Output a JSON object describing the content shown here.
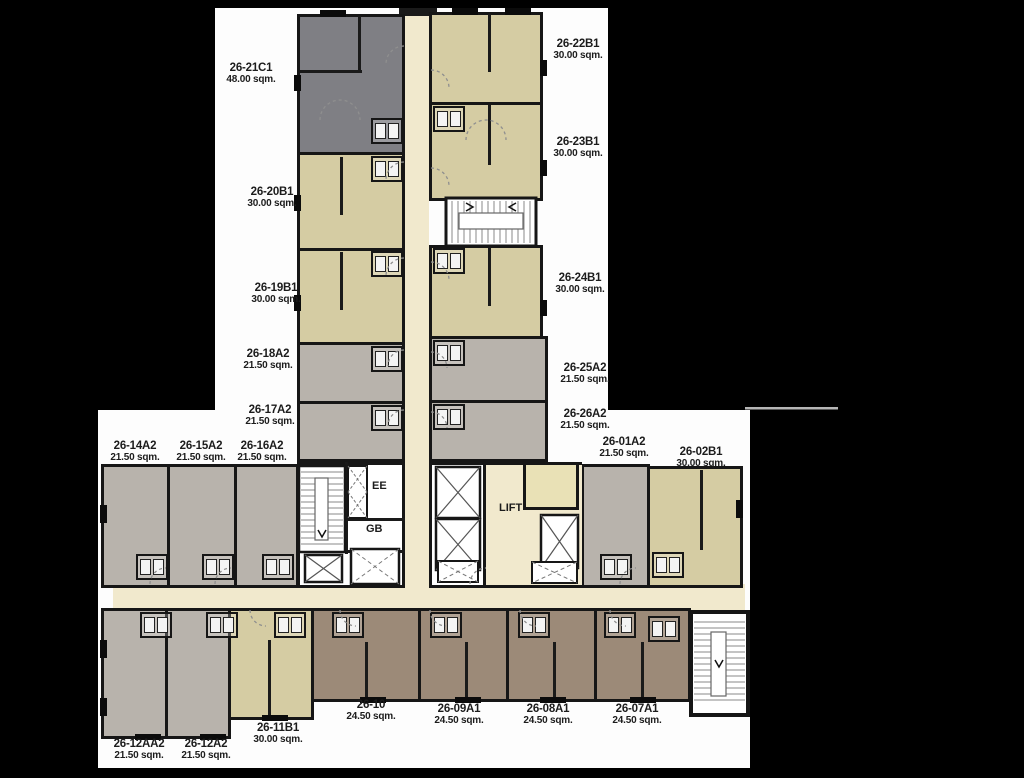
{
  "plan": {
    "type": "residential-floor-plan",
    "floor_prefix": "26",
    "colors": {
      "background": "#000000",
      "plan_paper": "#fdfdfd",
      "unit_c1_gray": "#7f7f84",
      "unit_b1_tan": "#d5cca3",
      "unit_a2_gray": "#b8b3ac",
      "unit_a1_brown": "#9c8a78",
      "corridor_cream": "#f1e9cd",
      "small_room_khaki": "#e9e1b6",
      "walls": "#161616"
    }
  },
  "core": {
    "ee": "EE",
    "gb": "GB",
    "lift": "LIFT"
  },
  "units": [
    {
      "id": "26-21C1",
      "area": "48.00 sqm."
    },
    {
      "id": "26-22B1",
      "area": "30.00 sqm."
    },
    {
      "id": "26-23B1",
      "area": "30.00 sqm."
    },
    {
      "id": "26-20B1",
      "area": "30.00 sqm."
    },
    {
      "id": "26-19B1",
      "area": "30.00 sqm."
    },
    {
      "id": "26-24B1",
      "area": "30.00 sqm."
    },
    {
      "id": "26-18A2",
      "area": "21.50 sqm."
    },
    {
      "id": "26-25A2",
      "area": "21.50 sqm."
    },
    {
      "id": "26-17A2",
      "area": "21.50 sqm."
    },
    {
      "id": "26-26A2",
      "area": "21.50 sqm."
    },
    {
      "id": "26-14A2",
      "area": "21.50 sqm."
    },
    {
      "id": "26-15A2",
      "area": "21.50 sqm."
    },
    {
      "id": "26-16A2",
      "area": "21.50 sqm."
    },
    {
      "id": "26-01A2",
      "area": "21.50 sqm."
    },
    {
      "id": "26-02B1",
      "area": "30.00 sqm."
    },
    {
      "id": "26-12AA2",
      "area": "21.50 sqm."
    },
    {
      "id": "26-12A2",
      "area": "21.50 sqm."
    },
    {
      "id": "26-11B1",
      "area": "30.00 sqm."
    },
    {
      "id": "26-10",
      "area": "24.50 sqm."
    },
    {
      "id": "26-09A1",
      "area": "24.50 sqm."
    },
    {
      "id": "26-08A1",
      "area": "24.50 sqm."
    },
    {
      "id": "26-07A1",
      "area": "24.50 sqm."
    }
  ]
}
